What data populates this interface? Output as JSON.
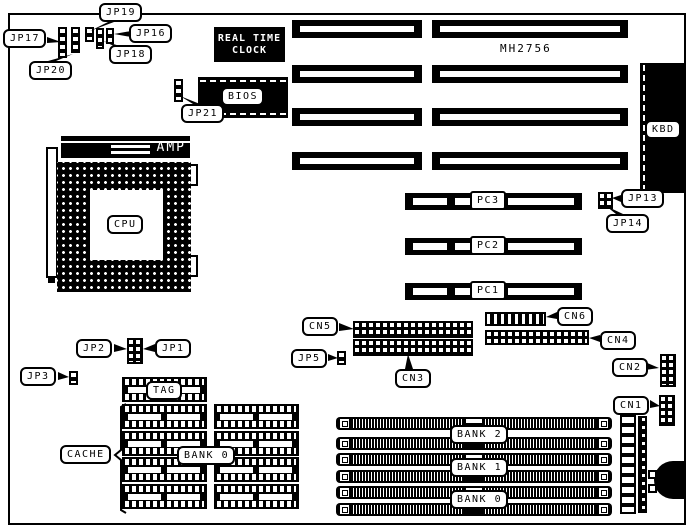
{
  "diagram": {
    "board_marking": "MH2756",
    "rtc": {
      "line1": "REAL TIME",
      "line2": "CLOCK"
    },
    "chips": {
      "bios": "BIOS",
      "cpu": "CPU",
      "amp": "AMP",
      "tag": "TAG",
      "kbd": "KBD"
    },
    "jumpers": {
      "jp1": "JP1",
      "jp2": "JP2",
      "jp3": "JP3",
      "jp5": "JP5",
      "jp13": "JP13",
      "jp14": "JP14",
      "jp16": "JP16",
      "jp17": "JP17",
      "jp18": "JP18",
      "jp19": "JP19",
      "jp20": "JP20",
      "jp21": "JP21"
    },
    "connectors": {
      "cn1": "CN1",
      "cn2": "CN2",
      "cn3": "CN3",
      "cn4": "CN4",
      "cn5": "CN5",
      "cn6": "CN6"
    },
    "pci_slots": [
      "PC3",
      "PC2",
      "PC1"
    ],
    "memory": {
      "cache_label": "CACHE",
      "cache_bank": "BANK 0",
      "simm_banks": [
        "BANK 2",
        "BANK 1",
        "BANK 0"
      ]
    },
    "colors": {
      "ink": "#000000",
      "paper": "#ffffff"
    }
  }
}
